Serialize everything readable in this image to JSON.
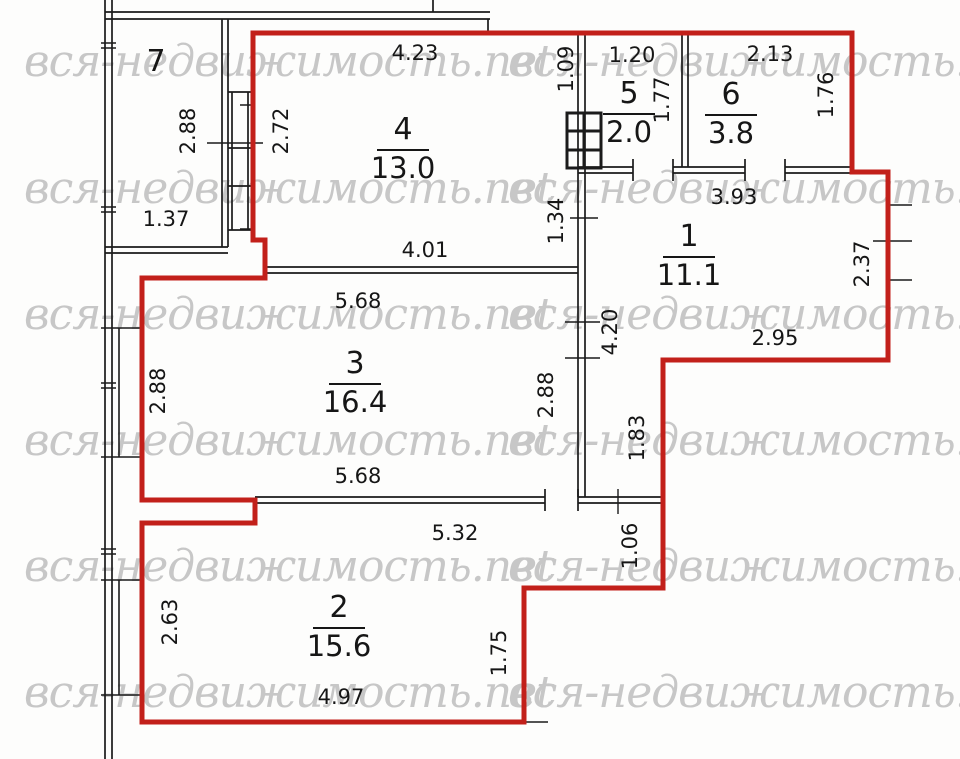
{
  "title": "apartment floor plan scan",
  "watermark": {
    "text": "вся-недвижимость.net"
  },
  "colors": {
    "outline_red": "#c2201a",
    "wall_black": "#1b1b1b",
    "watermark_gray": "#c7c7c7",
    "background": "#fdfdfc"
  },
  "rooms": [
    {
      "number": "7",
      "area": null
    },
    {
      "number": "4",
      "area": "13.0"
    },
    {
      "number": "5",
      "area": "2.0"
    },
    {
      "number": "6",
      "area": "3.8"
    },
    {
      "number": "1",
      "area": "11.1"
    },
    {
      "number": "3",
      "area": "16.4"
    },
    {
      "number": "2",
      "area": "15.6"
    }
  ],
  "dims": [
    "4.23",
    "1.20",
    "2.13",
    "2.88",
    "2.72",
    "1.09",
    "1.77",
    "1.76",
    "1.37",
    "1.34",
    "3.93",
    "2.37",
    "4.01",
    "5.68",
    "2.95",
    "4.20",
    "2.88",
    "2.88",
    "1.83",
    "5.68",
    "5.32",
    "1.06",
    "2.63",
    "1.75",
    "4.97"
  ]
}
